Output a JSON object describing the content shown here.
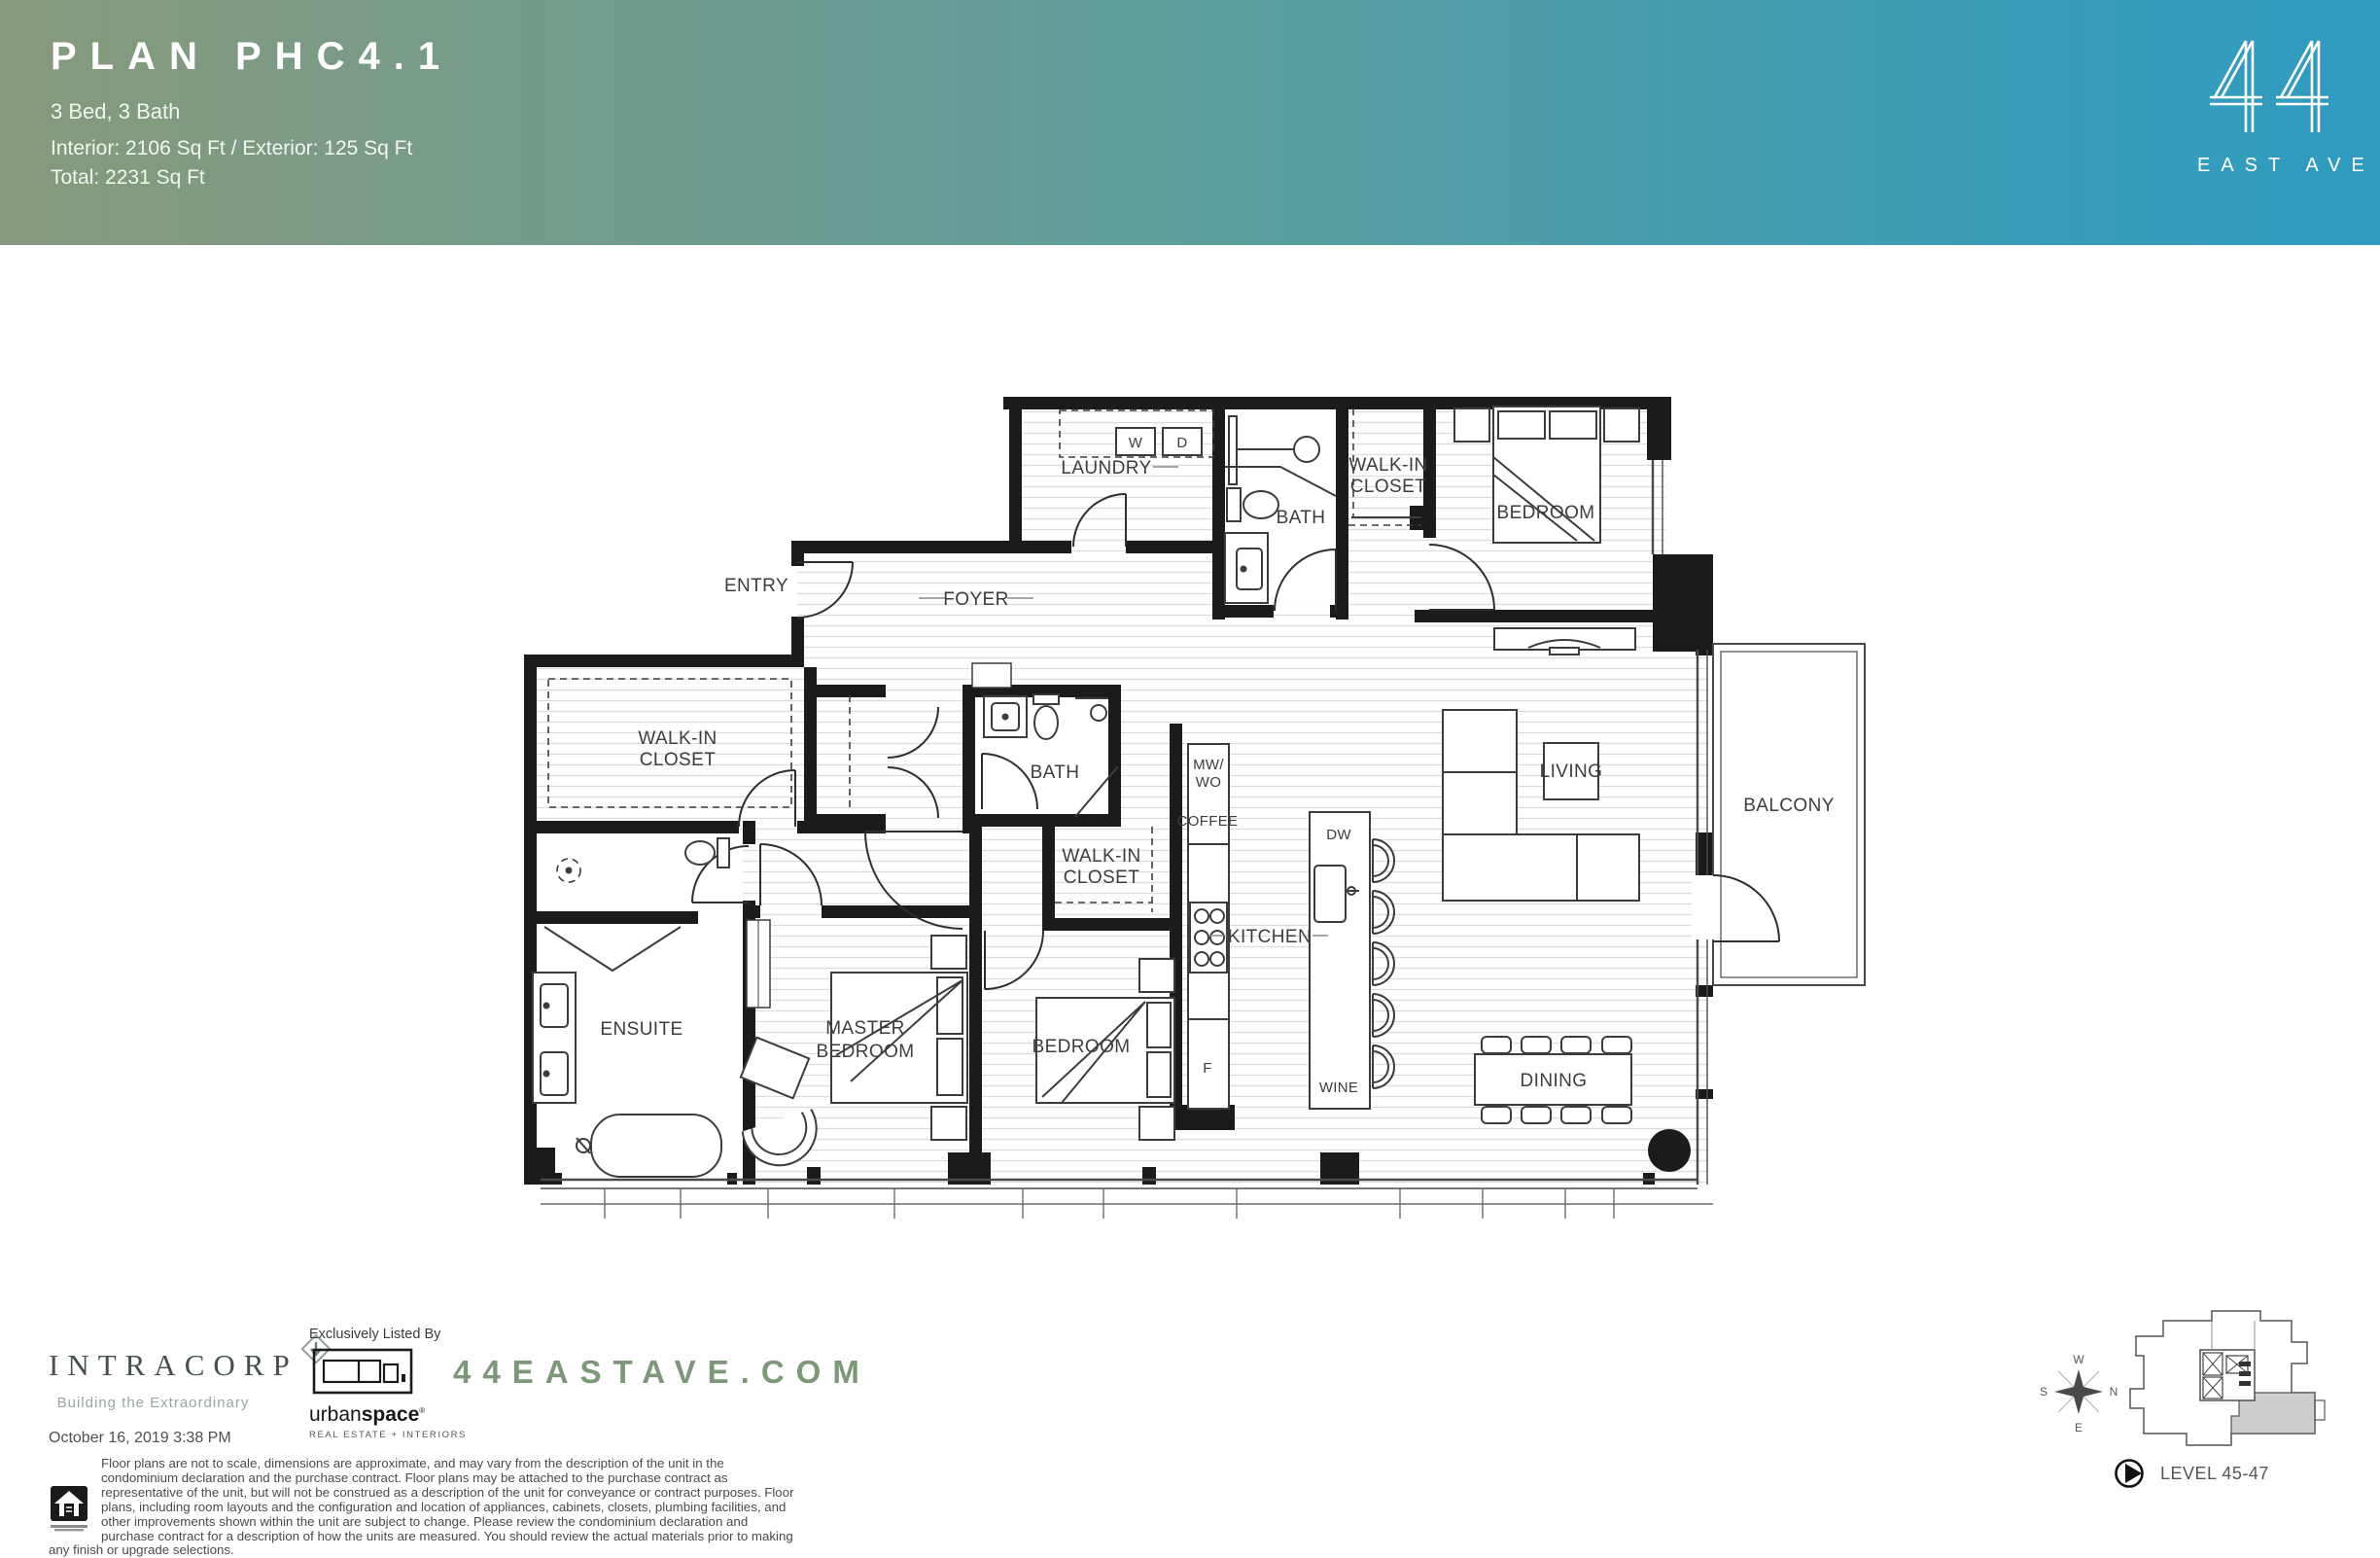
{
  "header": {
    "title": "PLAN PHC4.1",
    "subtitle": "3 Bed, 3 Bath",
    "area_interior": "Interior: 2106 Sq Ft / Exterior: 125 Sq Ft",
    "area_total": "Total: 2231 Sq Ft",
    "gradient_left": "#87997c",
    "gradient_right": "#2f9bc0"
  },
  "brand": {
    "number": "44",
    "name": "EAST AVE"
  },
  "plan": {
    "labels": {
      "entry": "ENTRY",
      "foyer": "FOYER",
      "laundry": "LAUNDRY",
      "washer": "W",
      "dryer": "D",
      "bath_upper": "BATH",
      "wic_upper_1": "WALK-IN",
      "wic_upper_2": "CLOSET",
      "bedroom_upper": "BEDROOM",
      "wic_left_1": "WALK-IN",
      "wic_left_2": "CLOSET",
      "bath_mid": "BATH",
      "wic_mid_1": "WALK-IN",
      "wic_mid_2": "CLOSET",
      "mw_1": "MW/",
      "mw_2": "WO",
      "coffee": "COFFEE",
      "dw": "DW",
      "kitchen": "KITCHEN",
      "fridge": "F",
      "wine": "WINE",
      "living": "LIVING",
      "balcony": "BALCONY",
      "ensuite": "ENSUITE",
      "master_1": "MASTER",
      "master_2": "BEDROOM",
      "bedroom_mid": "BEDROOM",
      "dining": "DINING"
    }
  },
  "footer": {
    "intracorp": "INTRACORP",
    "intracorp_tagline": "Building the Extraordinary",
    "listed_by": "Exclusively Listed By",
    "brokerage_light": "urban",
    "brokerage_bold": "space",
    "brokerage_reg": "®",
    "brokerage_sub": "REAL ESTATE + INTERIORS",
    "website": "44EASTAVE.COM",
    "date": "October 16, 2019 3:38 PM",
    "disclaimer": "Floor plans are not to scale, dimensions are approximate, and may vary from the description of the unit in the condominium declaration and the purchase contract. Floor plans may be attached to the purchase contract as representative of the unit, but will not be construed as a description of the unit for conveyance or contract purposes.  Floor plans, including room layouts and the configuration and location of appliances, cabinets, closets, plumbing facilities, and other improvements shown within the unit are subject to change.  Please review the condominium declaration and purchase contract for a description of how the units are measured.  You should review the actual materials prior to making any finish or upgrade selections.",
    "level": "LEVEL 45-47",
    "compass": {
      "n": "N",
      "s": "S",
      "e": "E",
      "w": "W"
    }
  }
}
